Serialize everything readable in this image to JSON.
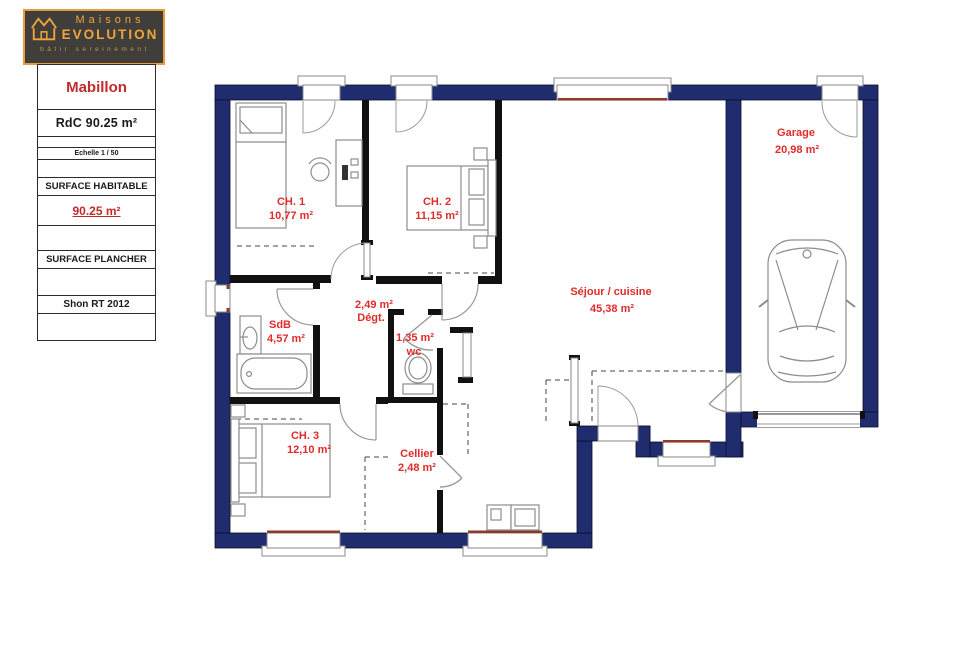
{
  "logo": {
    "brand_top": "Maisons",
    "brand_bottom": "EVOLUTION",
    "tagline": "bâtir sereinement"
  },
  "sidebar": {
    "model_name": "Mabillon",
    "floor_label": "RdC 90.25 m²",
    "scale_label": "Echelle 1 / 50",
    "surface_habitable_label": "SURFACE HABITABLE",
    "surface_habitable_value": "90.25 m²",
    "surface_plancher_label": "SURFACE PLANCHER",
    "shon_label": "Shon RT 2012"
  },
  "plan": {
    "rooms": {
      "ch1": {
        "name": "CH. 1",
        "area": "10,77 m²"
      },
      "ch2": {
        "name": "CH. 2",
        "area": "11,15 m²"
      },
      "sdb": {
        "name": "SdB",
        "area": "4,57 m²"
      },
      "degt": {
        "name": "Dégt.",
        "area": "2,49 m²"
      },
      "wc": {
        "name": "wc",
        "area": "1,35 m²"
      },
      "ch3": {
        "name": "CH. 3",
        "area": "12,10 m²"
      },
      "cellier": {
        "name": "Cellier",
        "area": "2,48 m²"
      },
      "sejour": {
        "name": "Séjour / cuisine",
        "area": "45,38 m²"
      },
      "garage": {
        "name": "Garage",
        "area": "20,98 m²"
      }
    },
    "colors": {
      "exterior_wall": "#1f2c6d",
      "interior_wall": "#111111",
      "room_label": "#e02b2b",
      "window_sill": "#8c3b2b",
      "logo_accent": "#f0a43c"
    }
  }
}
